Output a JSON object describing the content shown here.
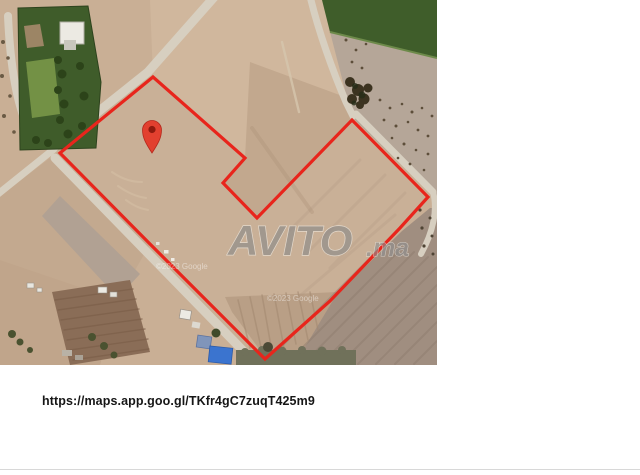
{
  "map": {
    "parcel": {
      "outline_points": "153,77 245,158 223,183 257,218 352,120 428,197 400,228 330,301 265,359 150,244 60,153",
      "outline_color": "#e8251c"
    },
    "pin": {
      "transform": "translate(152,130)",
      "color": "#e2402f",
      "inner_color": "#8f1a0e"
    },
    "watermark": {
      "brand": "AVITO",
      "tld": ".ma",
      "color": "#8a8a8a"
    },
    "credits": [
      {
        "text": "©2023 Google"
      },
      {
        "text": "©2023 Google"
      }
    ]
  },
  "footer": {
    "url": "https://maps.app.goo.gl/TKfr4gC7zuqT425m9"
  }
}
